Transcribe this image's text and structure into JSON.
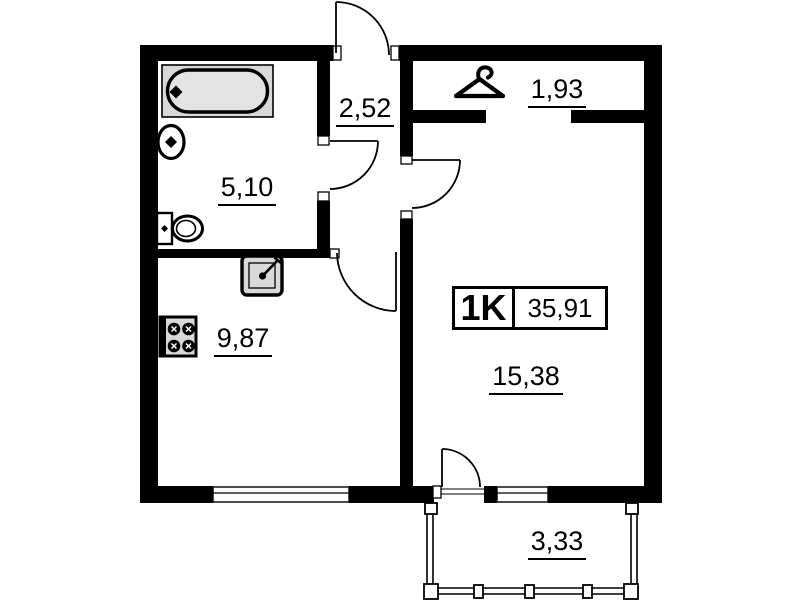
{
  "colors": {
    "wall": "#000000",
    "fixture_fill": "#d9d9d9",
    "background": "#ffffff"
  },
  "apartment": {
    "type_label": "1K",
    "total_area": "35,91"
  },
  "rooms": {
    "hallway": {
      "area": "2,52"
    },
    "bathroom": {
      "area": "5,10"
    },
    "wardrobe": {
      "area": "1,93"
    },
    "kitchen": {
      "area": "9,87"
    },
    "living_room": {
      "area": "15,38"
    },
    "balcony": {
      "area": "3,33"
    }
  },
  "icons": {
    "wardrobe": "hanger-icon",
    "bathtub": "bathtub-icon",
    "washbasin": "washbasin-icon",
    "toilet": "toilet-icon",
    "kitchen_sink": "kitchen-sink-icon",
    "stove": "stove-icon"
  }
}
